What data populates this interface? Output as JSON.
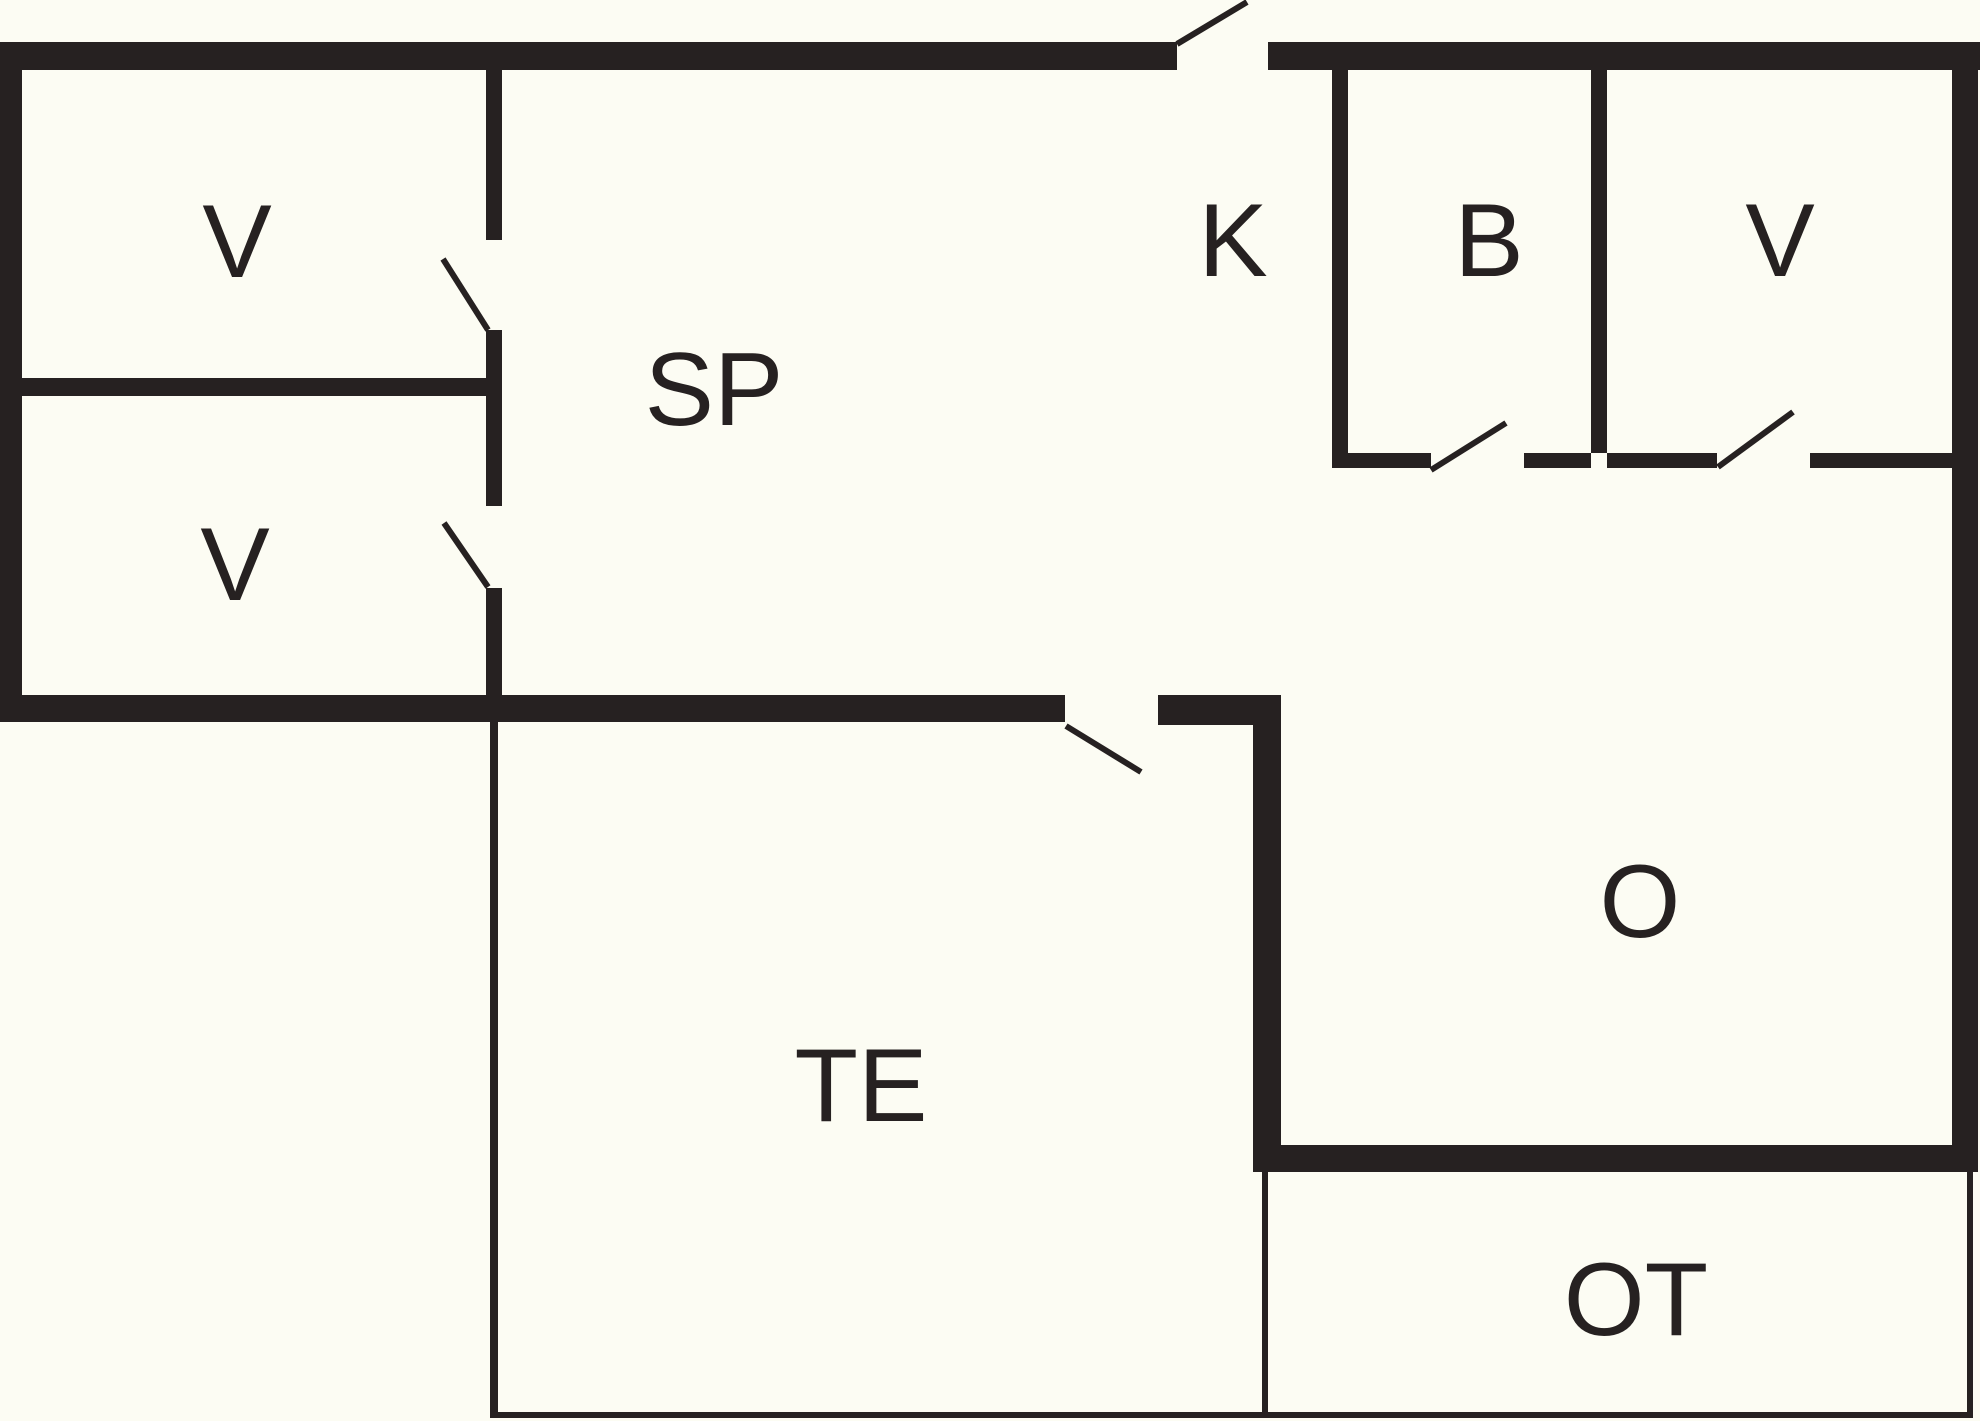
{
  "canvas": {
    "width": 1980,
    "height": 1421,
    "background_color": "#FCFCF3",
    "ink_color": "#262121"
  },
  "floorplan": {
    "rooms": [
      {
        "id": "v-top-left",
        "label": "V",
        "x": 237,
        "y": 242
      },
      {
        "id": "v-lower-left",
        "label": "V",
        "x": 235,
        "y": 565
      },
      {
        "id": "sp",
        "label": "SP",
        "x": 714,
        "y": 390
      },
      {
        "id": "k",
        "label": "K",
        "x": 1233,
        "y": 241
      },
      {
        "id": "b",
        "label": "B",
        "x": 1489,
        "y": 241
      },
      {
        "id": "v-top-right",
        "label": "V",
        "x": 1780,
        "y": 241
      },
      {
        "id": "o",
        "label": "O",
        "x": 1640,
        "y": 902
      },
      {
        "id": "te",
        "label": "TE",
        "x": 861,
        "y": 1086
      },
      {
        "id": "ot",
        "label": "OT",
        "x": 1636,
        "y": 1300
      }
    ],
    "walls": [
      {
        "name": "exterior-top-wall-left-of-entrance",
        "x": 0,
        "y": 42,
        "w": 1177,
        "h": 28
      },
      {
        "name": "exterior-top-wall-right-of-entrance",
        "x": 1268,
        "y": 42,
        "w": 712,
        "h": 28
      },
      {
        "name": "exterior-left-wall",
        "x": 0,
        "y": 42,
        "w": 22,
        "h": 680
      },
      {
        "name": "exterior-right-wall",
        "x": 1952,
        "y": 42,
        "w": 26,
        "h": 1130
      },
      {
        "name": "left-wing-bottom-wall",
        "x": 0,
        "y": 695,
        "w": 1065,
        "h": 27
      },
      {
        "name": "te-top-wall-right-of-door",
        "x": 1158,
        "y": 695,
        "w": 123,
        "h": 30
      },
      {
        "name": "v-sp-wall-upper-segment",
        "x": 486,
        "y": 70,
        "w": 16,
        "h": 170
      },
      {
        "name": "v-sp-wall-middle-segment",
        "x": 486,
        "y": 330,
        "w": 16,
        "h": 176
      },
      {
        "name": "v-sp-wall-lower-segment",
        "x": 486,
        "y": 588,
        "w": 16,
        "h": 107
      },
      {
        "name": "v-v-divider-wall",
        "x": 22,
        "y": 378,
        "w": 480,
        "h": 18
      },
      {
        "name": "te-o-wall",
        "x": 1253,
        "y": 695,
        "w": 28,
        "h": 477
      },
      {
        "name": "k-b-wall",
        "x": 1332,
        "y": 70,
        "w": 16,
        "h": 398
      },
      {
        "name": "b-v-wall",
        "x": 1591,
        "y": 70,
        "w": 16,
        "h": 383
      },
      {
        "name": "kbv-bottom-wall-segment-1",
        "x": 1332,
        "y": 453,
        "w": 99,
        "h": 15
      },
      {
        "name": "kbv-bottom-wall-segment-2",
        "x": 1524,
        "y": 453,
        "w": 67,
        "h": 15
      },
      {
        "name": "kbv-bottom-wall-segment-3",
        "x": 1607,
        "y": 453,
        "w": 110,
        "h": 15
      },
      {
        "name": "kbv-bottom-wall-segment-4",
        "x": 1810,
        "y": 453,
        "w": 142,
        "h": 15
      },
      {
        "name": "o-bottom-wall",
        "x": 1253,
        "y": 1145,
        "w": 725,
        "h": 27
      }
    ],
    "thin_lines": [
      {
        "name": "te-left-boundary-line",
        "x": 490,
        "y": 722,
        "w": 8,
        "h": 696
      },
      {
        "name": "bottom-boundary-line",
        "x": 490,
        "y": 1412,
        "w": 1483,
        "h": 6
      },
      {
        "name": "ot-left-boundary-line",
        "x": 1262,
        "y": 1172,
        "w": 6,
        "h": 246
      },
      {
        "name": "ot-right-boundary-line",
        "x": 1967,
        "y": 1172,
        "w": 6,
        "h": 246
      }
    ],
    "door_leaves": [
      {
        "name": "entrance-door-swing",
        "x1": 1177,
        "y1": 44,
        "x2": 1247,
        "y2": 2
      },
      {
        "name": "v-top-left-door-swing",
        "x1": 443,
        "y1": 259,
        "x2": 488,
        "y2": 330
      },
      {
        "name": "v-lower-left-door-swing",
        "x1": 444,
        "y1": 523,
        "x2": 488,
        "y2": 587
      },
      {
        "name": "te-door-swing",
        "x1": 1066,
        "y1": 726,
        "x2": 1141,
        "y2": 772
      },
      {
        "name": "b-door-swing",
        "x1": 1431,
        "y1": 470,
        "x2": 1506,
        "y2": 423
      },
      {
        "name": "v-top-right-door-swing",
        "x1": 1718,
        "y1": 467,
        "x2": 1793,
        "y2": 412
      }
    ]
  }
}
